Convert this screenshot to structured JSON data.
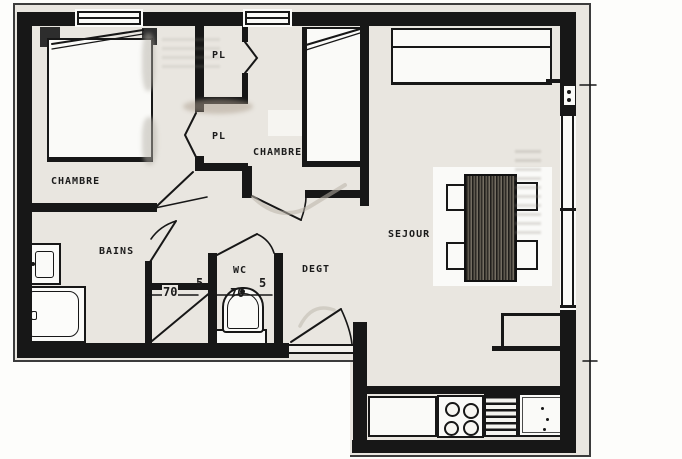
{
  "plan": {
    "title": "apartment-floor-plan-scan",
    "rooms": [
      {
        "id": "chambre-1",
        "label": "CHAMBRE"
      },
      {
        "id": "placard-top",
        "label": "PL"
      },
      {
        "id": "placard-bottom",
        "label": "PL"
      },
      {
        "id": "chambre-2",
        "label": "CHAMBRE"
      },
      {
        "id": "bains",
        "label": "BAINS"
      },
      {
        "id": "wc",
        "label": "WC"
      },
      {
        "id": "degagement",
        "label": "DEGT"
      },
      {
        "id": "sejour",
        "label": "SEJOUR"
      }
    ],
    "dimensions": [
      {
        "id": "shower-width",
        "value": "70"
      },
      {
        "id": "partition-left",
        "value": "5"
      },
      {
        "id": "wc-width",
        "value": "70"
      },
      {
        "id": "partition-right",
        "value": "5"
      }
    ],
    "colors": {
      "paper": "#e9e6e0",
      "ink": "#171717",
      "fixture_white": "#fafaf8"
    }
  }
}
